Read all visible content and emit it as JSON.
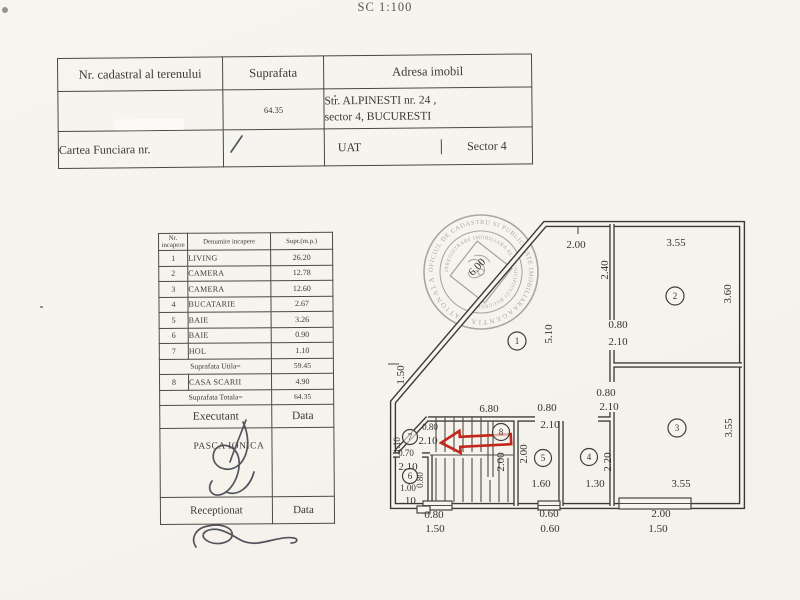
{
  "scale_label": "SC 1:100",
  "top_table": {
    "headers": {
      "cadastral": "Nr. cadastral al terenului",
      "suprafata": "Suprafata",
      "adresa": "Adresa imobil"
    },
    "suprafata_value": "64.35",
    "address_line1": "Str. ALPINESTI nr. 24 ,",
    "address_line2": "sector 4, BUCURESTI",
    "cartea_funciara_label": "Cartea Funciara nr.",
    "uat_label": "UAT",
    "uat_value": "Sector 4"
  },
  "room_table": {
    "headers": {
      "nr": "Nr. incapere",
      "denumire": "Denumire incapere",
      "supr": "Supr.(m.p.)"
    },
    "rows": [
      {
        "nr": "1",
        "name": "LIVING",
        "area": "26.20"
      },
      {
        "nr": "2",
        "name": "CAMERA",
        "area": "12.78"
      },
      {
        "nr": "3",
        "name": "CAMERA",
        "area": "12.60"
      },
      {
        "nr": "4",
        "name": "BUCATARIE",
        "area": "2.67"
      },
      {
        "nr": "5",
        "name": "BAIE",
        "area": "3.26"
      },
      {
        "nr": "6",
        "name": "BAIE",
        "area": "0.90"
      },
      {
        "nr": "7",
        "name": "HOL",
        "area": "1.10"
      }
    ],
    "suprafata_utila_label": "Suprafata Utila=",
    "suprafata_utila_value": "59.45",
    "row8": {
      "nr": "8",
      "name": "CASA SCARII",
      "area": "4.90"
    },
    "suprafata_totala_label": "Suprafata Totala=",
    "suprafata_totala_value": "64.35",
    "executant_label": "Executant",
    "executant_data_label": "Data",
    "executant_name": "PASCA IONICA",
    "receptionat_label": "Receptionat",
    "receptionat_data_label": "Data"
  },
  "plan": {
    "room_numbers": {
      "r1": "1",
      "r2": "2",
      "r3": "3",
      "r4": "4",
      "r5": "5",
      "r6": "6",
      "r7": "7",
      "r8": "8"
    },
    "dims": {
      "top_left": "2.00",
      "room2_w": "3.55",
      "room2_wall": "2.40",
      "door2_w": "0.80",
      "door2_h": "2.10",
      "room2_h": "3.60",
      "room1_h": "5.10",
      "diag": "6.00",
      "left_wall": "1.50",
      "strip_w": "6.80",
      "door5_w": "0.80",
      "door5_h": "2.10",
      "door3_w": "0.80",
      "door3_h": "2.10",
      "door7_w": "0.80",
      "door7_h": "2.10",
      "hall_w": "1.10",
      "door6_w": "0.70",
      "door6_h": "2.10",
      "room6_w": "1.00",
      "room6_h": "0.80",
      "stair_h": "2.00",
      "room5_h": "2.00",
      "room5_w": "1.60",
      "room4_h": "2.20",
      "room4_w": "1.30",
      "room3_h": "3.55",
      "room3_w": "3.55",
      "offset": ".10",
      "win1_a": "0.80",
      "win1_b": "1.50",
      "win2_a": "0.60",
      "win2_b": "0.60",
      "win3_a": "2.00",
      "win3_b": "1.50"
    }
  },
  "stamp": {
    "ring_top": "OFICIUL DE CADASTRU SI PUBLICITATE IMOBILIARA",
    "ring_bottom": "AGENTIA NATIONALA",
    "inner_ring": "INREGISTRARE IMOBILIARA AL MUNICIPIULUI BUCURESTI"
  }
}
